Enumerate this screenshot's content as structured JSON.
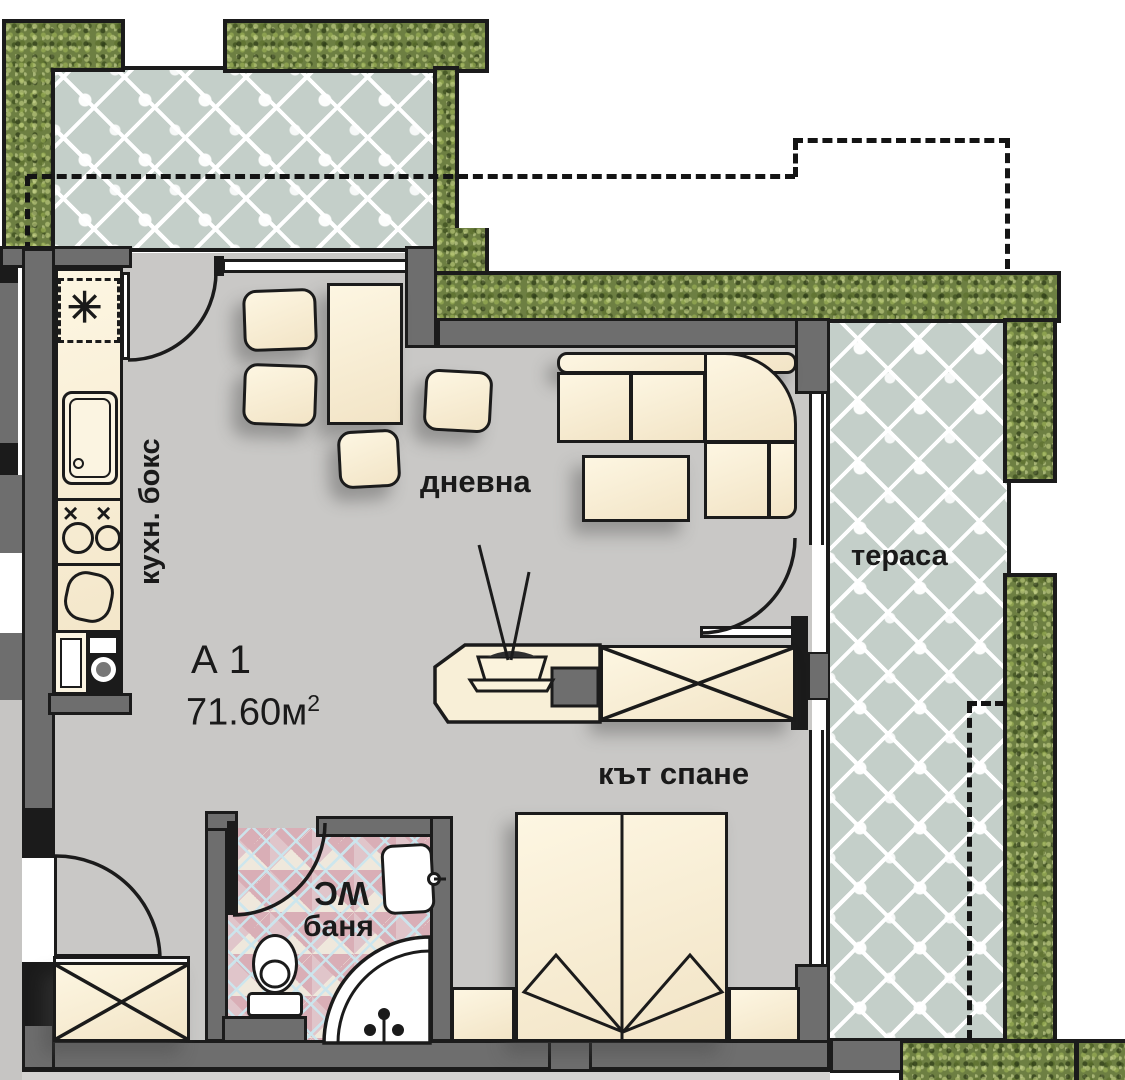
{
  "floorplan": {
    "unit": {
      "title": "А 1",
      "area_value": "71.60м",
      "area_superscript": "2"
    },
    "labels": {
      "living_room": "дневна",
      "kitchen": "кухн. бокс",
      "terrace": "тераса",
      "sleeping_nook": "кът спане",
      "wc": "WC",
      "bathroom": "баня"
    },
    "symbols": {
      "fridge_star": "✳",
      "hob_cross": "×"
    },
    "colors": {
      "wall_fill": "#6e6e6e",
      "outline": "#1b1b1b",
      "floor": "#c9c8c6",
      "furniture": "#f8efd7",
      "terrace_tile": "#c4cfc9",
      "bath_tile_pink": "#d9aeb6",
      "bath_grout_blue": "#cbe6ee",
      "grass_green": "#6d7f42"
    }
  }
}
